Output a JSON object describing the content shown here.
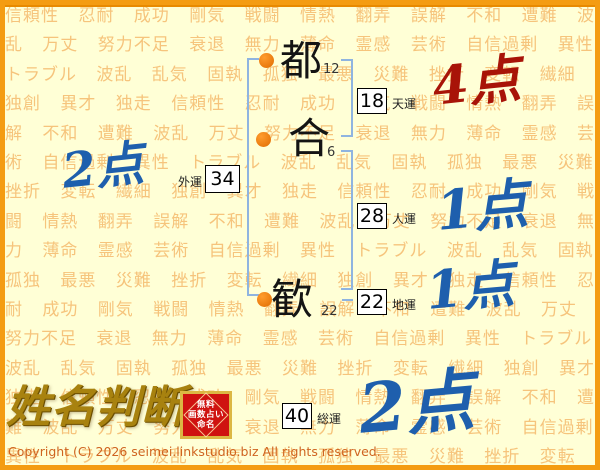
{
  "page": {
    "background_color": "#ffffd6",
    "frame_color": "#f49c12",
    "pattern_color": "#f6c47c",
    "pattern_words": "信頼性 忍耐 成功 剛気 戦闘 情熱 翻弄 誤解 不和 遭難 波乱 万丈 努力不足 衰退 無力 薄命 霊感 芸術 自信過剰 異性 トラブル 波乱 乱気 固執 孤独 最悪 災難 挫折 変転 繊細 独創 異才 独走",
    "pattern_repeat": 6
  },
  "name_chart": {
    "bullet_color": "#e8791a",
    "bracket_color": "#8fb4e0",
    "characters": [
      {
        "char": "都",
        "strokes": "12"
      },
      {
        "char": "合",
        "strokes": "6"
      },
      {
        "char": "歓",
        "strokes": "22"
      }
    ],
    "fortunes": [
      {
        "label": "天運",
        "value": "18",
        "score": "4点",
        "score_color": "#a81408"
      },
      {
        "label": "外運",
        "value": "34",
        "score": "2点",
        "score_color": "#1e5fad"
      },
      {
        "label": "人運",
        "value": "28",
        "score": "1点",
        "score_color": "#1e5fad"
      },
      {
        "label": "地運",
        "value": "22",
        "score": "1点",
        "score_color": "#1e5fad"
      },
      {
        "label": "総運",
        "value": "40",
        "score": "2点",
        "score_color": "#1e5fad"
      }
    ]
  },
  "footer": {
    "logo_text": "姓名判断",
    "seal_lines": [
      "無料",
      "画数占い",
      "命名"
    ],
    "copyright": "Copyright (C) 2026 seimei.linkstudio.biz All rights reserved."
  }
}
